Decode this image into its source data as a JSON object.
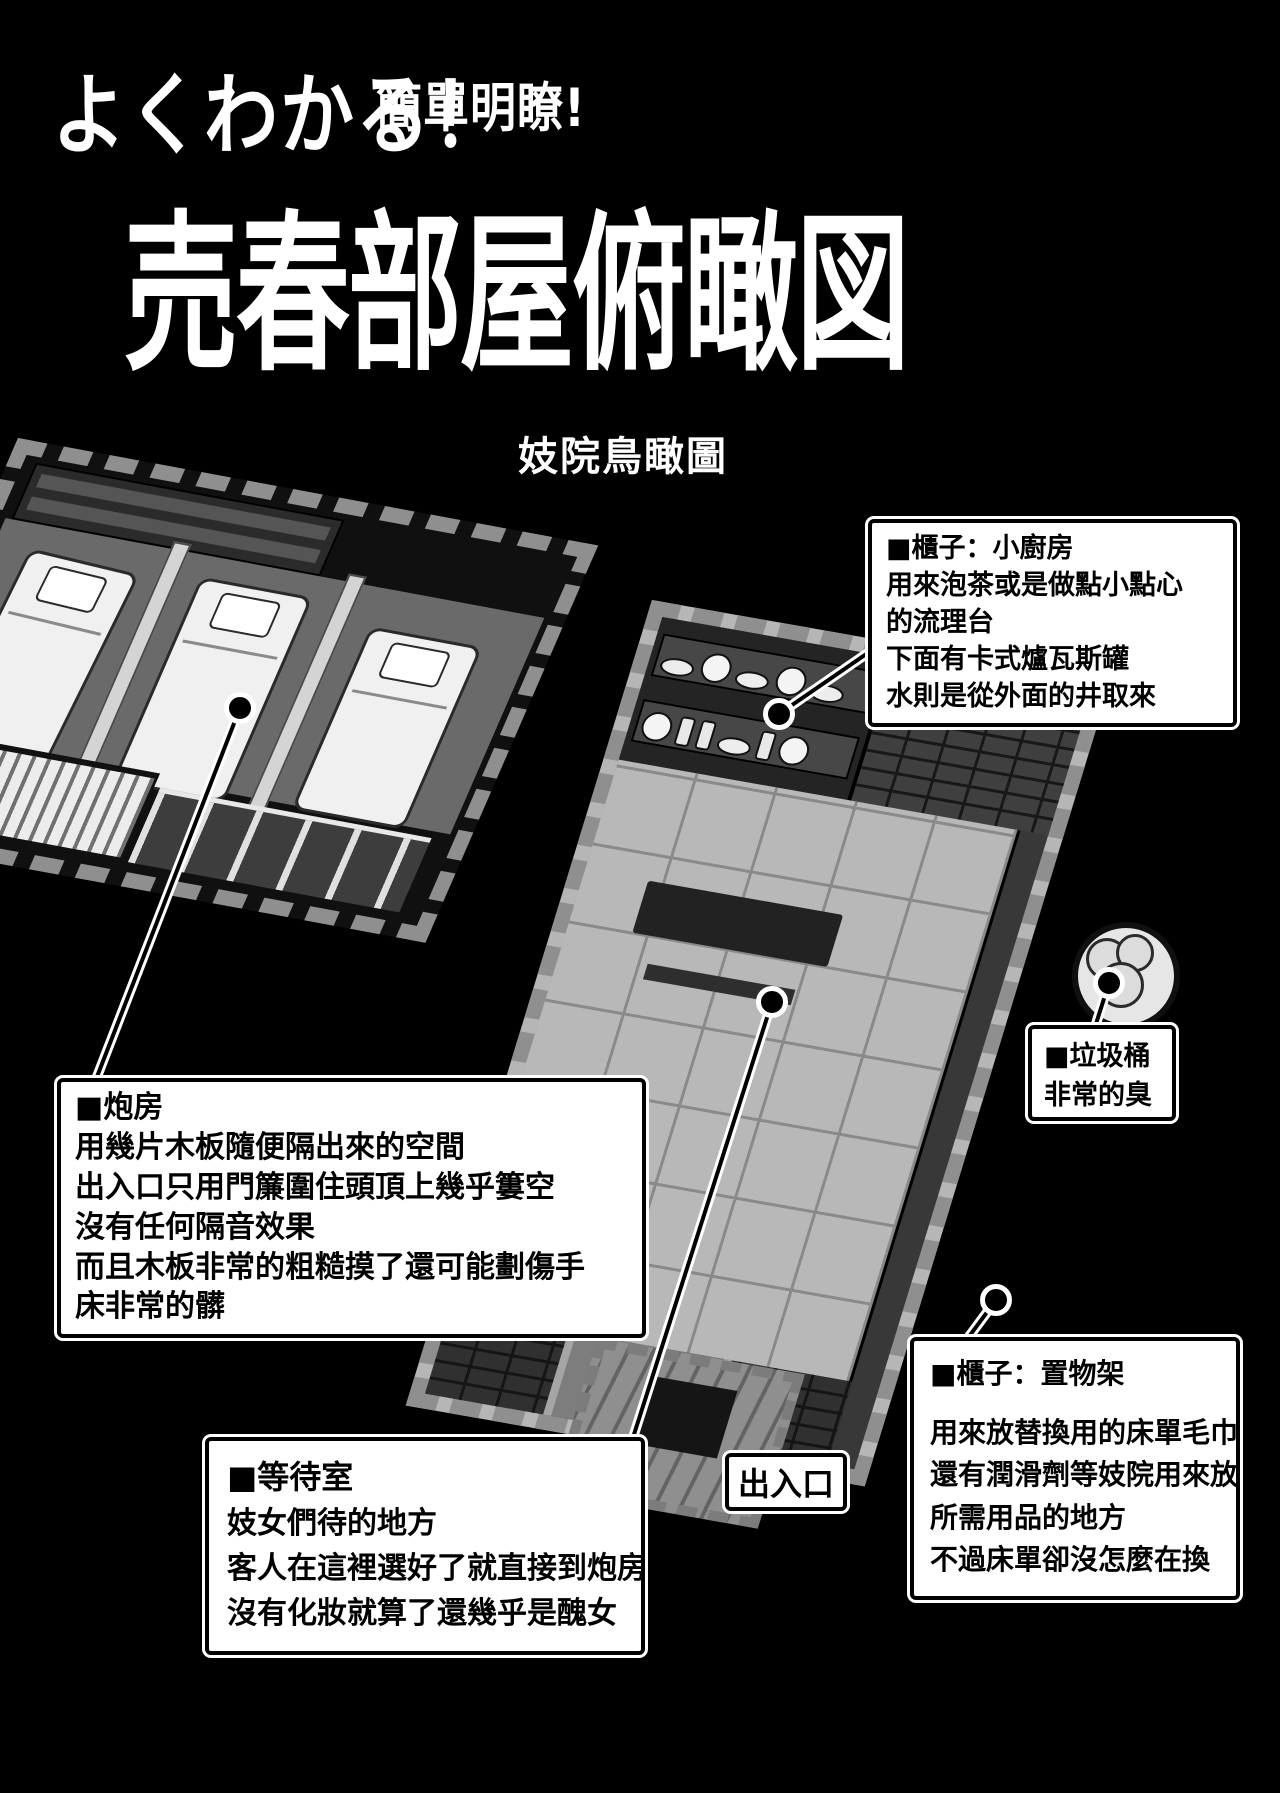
{
  "header": {
    "title_jp": "よくわかる！",
    "title_zh": "簡單明瞭!",
    "main_title": "売春部屋俯瞰図",
    "subtitle": "妓院鳥瞰圖"
  },
  "annotations": {
    "kitchen": {
      "title": "■櫃子：小廚房",
      "lines": [
        "用來泡茶或是做點小點心",
        "的流理台",
        "下面有卡式爐瓦斯罐",
        "水則是從外面的井取來"
      ]
    },
    "trash": {
      "title": "■垃圾桶",
      "lines": [
        "非常的臭"
      ]
    },
    "bedroom": {
      "title": "■炮房",
      "lines": [
        "用幾片木板隨便隔出來的空間",
        "出入口只用門簾圍住頭頂上幾乎簍空",
        "沒有任何隔音效果",
        "而且木板非常的粗糙摸了還可能劃傷手",
        "床非常的髒"
      ]
    },
    "waiting": {
      "title": "■等待室",
      "lines": [
        "妓女們待的地方",
        "客人在這裡選好了就直接到炮房",
        "沒有化妝就算了還幾乎是醜女"
      ]
    },
    "shelf": {
      "title": "■櫃子：置物架",
      "lines": [
        "用來放替換用的床單毛巾",
        "還有潤滑劑等妓院用來放",
        "所需用品的地方",
        "不過床單卻沒怎麼在換"
      ]
    },
    "exit": {
      "label": "出入口"
    }
  },
  "colors": {
    "background": "#000000",
    "box_bg": "#ffffff",
    "box_border": "#000000",
    "box_text": "#000000",
    "title_text": "#ffffff",
    "leader_casing": "#ffffff",
    "leader_core": "#000000",
    "floor_tile": "#b8b8b8",
    "wall_dark": "#303030",
    "stone_block": "#8f8f8f"
  }
}
